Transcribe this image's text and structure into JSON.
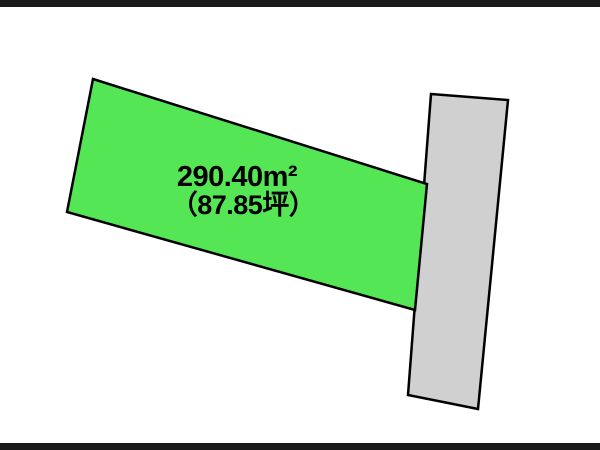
{
  "diagram": {
    "background": "#ffffff",
    "letterbox": {
      "color": "#1a1a1a"
    },
    "land_parcel": {
      "area_m2": "290.40m²",
      "area_tsubo": "（87.85坪）",
      "fill": "#55e655",
      "border": "#000000"
    },
    "road": {
      "fill": "#d0d0d0",
      "border": "#000000"
    }
  }
}
